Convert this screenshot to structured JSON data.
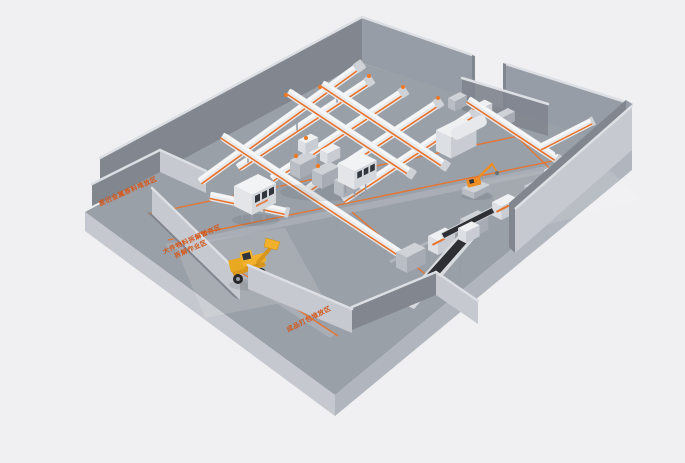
{
  "colors": {
    "background": "#f0f0f2",
    "floor": "#9aa0a8",
    "slab_left": "#c5c8ce",
    "slab_right": "#b1b6be",
    "wall_dark": "#81868f",
    "wall_mid": "#979da6",
    "wall_light": "#c6c9cf",
    "wall_top": "#dcdfe3",
    "accent": "#e8722a",
    "accent_deep": "#d4581c",
    "belt": "#2e2f34",
    "loader_yellow": "#f1b12c",
    "loader_dark": "#d9961c",
    "handler_orange": "#ee8d21"
  },
  "floor_labels": {
    "left_bay": "废旧金属原料堆放区",
    "dismantle_line1": "大件物料拆解暂存区",
    "dismantle_line2": "拆解作业区",
    "output_zone": "成品打包堆放区"
  }
}
